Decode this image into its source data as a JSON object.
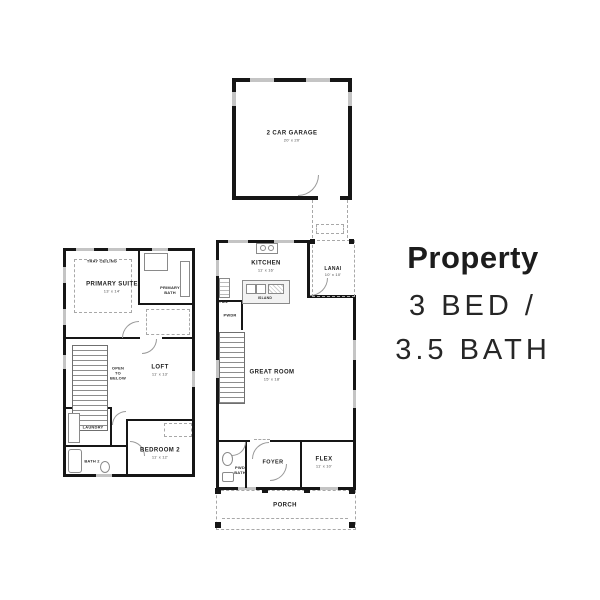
{
  "info": {
    "title": "Property",
    "bed_bath_line1": "3 BED /",
    "bed_bath_line2": "3.5 BATH"
  },
  "garage": {
    "label": "2 CAR GARAGE",
    "dims": "20' x 20'"
  },
  "second_floor": {
    "tray_ceiling": "TRAY CEILING",
    "primary_suite": {
      "label": "PRIMARY SUITE",
      "dims": "13' x 14'"
    },
    "primary_bath": {
      "label": "PRIMARY BATH"
    },
    "open_to_below": "OPEN TO BELOW",
    "loft": {
      "label": "LOFT",
      "dims": "11' x 13'"
    },
    "laundry": "LAUNDRY",
    "bath2": "BATH 2",
    "bedroom2": {
      "label": "BEDROOM 2",
      "dims": "11' x 12'"
    }
  },
  "first_floor": {
    "kitchen": {
      "label": "KITCHEN",
      "dims": "11' x 16'"
    },
    "island": "ISLAND",
    "pantry": "PAN.",
    "lanai": {
      "label": "LANAI",
      "dims": "10' x 10'"
    },
    "pwdr": "PWDR",
    "great_room": {
      "label": "GREAT ROOM",
      "dims": "15' x 18'"
    },
    "foyer": "FOYER",
    "flex": {
      "label": "FLEX",
      "dims": "11' x 10'"
    },
    "pwd_bath": "PWD BATH",
    "porch": "PORCH"
  },
  "colors": {
    "wall": "#161616",
    "window": "#c4c4c4",
    "dashed": "#a8a8a8",
    "text": "#1c1c1c"
  }
}
